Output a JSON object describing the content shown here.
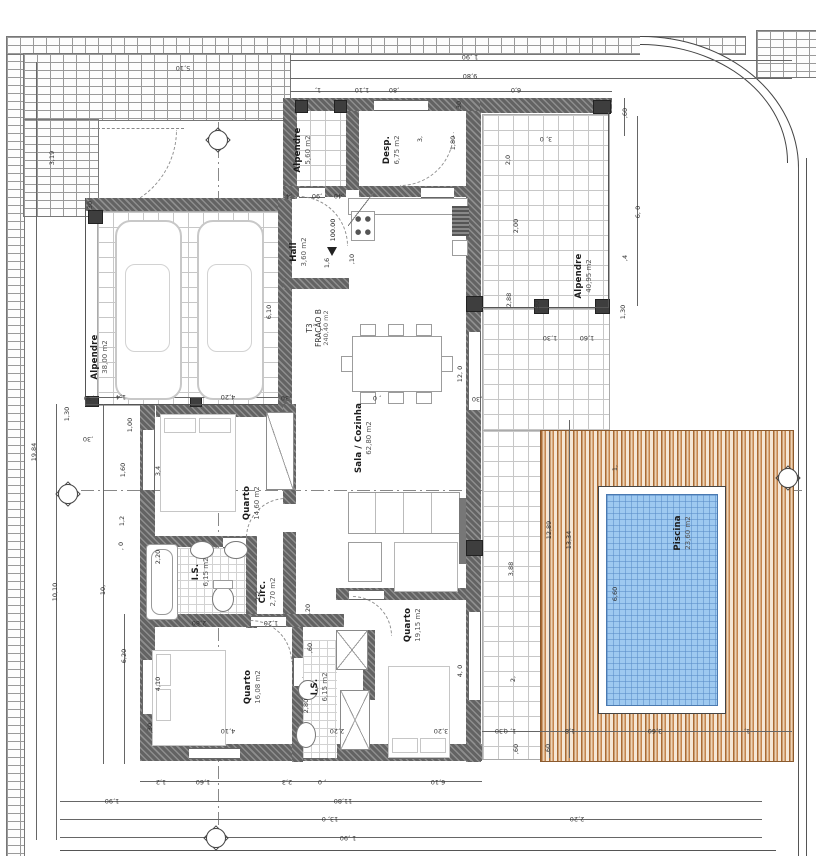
{
  "drawing": {
    "type_label": "T3",
    "fraction_label": "FRAÇÃO B",
    "fraction_area": "240,40 m2",
    "level": "100.00"
  },
  "colors": {
    "wall": "#636363",
    "pool_fill": "#9ec9f0",
    "deck_brown": "#a96a33",
    "line": "#444444"
  },
  "rooms": {
    "alpendre_garage": {
      "name": "Alpendre",
      "area": "38,00 m2"
    },
    "alpendre_small": {
      "name": "Alpendre",
      "area": "5,60 m2"
    },
    "desp": {
      "name": "Desp.",
      "area": "6,75 m2"
    },
    "hall": {
      "name": "Hall",
      "area": "3,60 m2"
    },
    "sala": {
      "name": "Sala / Cozinha",
      "area": "62,80 m2"
    },
    "alpendre_right": {
      "name": "Alpendre",
      "area": "40,95 m2"
    },
    "quarto1": {
      "name": "Quarto",
      "area": "14,60 m2"
    },
    "is1": {
      "name": "I.S.",
      "area": "6,15 m2"
    },
    "circ": {
      "name": "Circ.",
      "area": "2,70 m2"
    },
    "quarto2": {
      "name": "Quarto",
      "area": "16,08 m2"
    },
    "is2": {
      "name": "I.S.",
      "area": "6,15 m2"
    },
    "quarto3": {
      "name": "Quarto",
      "area": "19,15 m2"
    },
    "piscina": {
      "name": "Piscina",
      "area": "23,60 m2"
    }
  },
  "dim_labels": [
    {
      "t": "1 ,90",
      "x": 470,
      "y": 57,
      "r": 180
    },
    {
      "t": "9,80",
      "x": 470,
      "y": 76,
      "r": 180
    },
    {
      "t": "1,",
      "x": 318,
      "y": 90,
      "r": 180
    },
    {
      "t": "1,10",
      "x": 362,
      "y": 90,
      "r": 180
    },
    {
      "t": ",80",
      "x": 394,
      "y": 90,
      "r": 180
    },
    {
      "t": "6,0",
      "x": 516,
      "y": 90,
      "r": 180
    },
    {
      "t": "5,10",
      "x": 183,
      "y": 68,
      "r": 180
    },
    {
      "t": ",60",
      "x": 625,
      "y": 113,
      "r": -90
    },
    {
      "t": "3, 0",
      "x": 546,
      "y": 139,
      "r": 180
    },
    {
      "t": ",30",
      "x": 459,
      "y": 106,
      "r": -90
    },
    {
      "t": "2,0",
      "x": 508,
      "y": 160,
      "r": -90
    },
    {
      "t": "2,00",
      "x": 516,
      "y": 226,
      "r": -90
    },
    {
      "t": "2,88",
      "x": 509,
      "y": 300,
      "r": -90
    },
    {
      "t": "6, 0",
      "x": 638,
      "y": 212,
      "r": -90
    },
    {
      "t": ",4",
      "x": 625,
      "y": 258,
      "r": -90
    },
    {
      "t": "1,30",
      "x": 623,
      "y": 312,
      "r": -90
    },
    {
      "t": ",30",
      "x": 537,
      "y": 306,
      "r": -90
    },
    {
      "t": "1,30",
      "x": 550,
      "y": 338,
      "r": 180
    },
    {
      "t": "1,60",
      "x": 587,
      "y": 338,
      "r": 180
    },
    {
      "t": "19,84",
      "x": 34,
      "y": 452,
      "r": -90
    },
    {
      "t": "10,10",
      "x": 55,
      "y": 592,
      "r": -90
    },
    {
      "t": "10,",
      "x": 103,
      "y": 590,
      "r": -90
    },
    {
      "t": "6,20",
      "x": 124,
      "y": 656,
      "r": -90
    },
    {
      "t": "3,19",
      "x": 52,
      "y": 158,
      "r": -90
    },
    {
      "t": ",30",
      "x": 90,
      "y": 206,
      "r": -90
    },
    {
      "t": "6,10",
      "x": 269,
      "y": 312,
      "r": -90
    },
    {
      "t": "1,4",
      "x": 121,
      "y": 397,
      "r": 180
    },
    {
      "t": "4,20",
      "x": 228,
      "y": 397,
      "r": 180
    },
    {
      "t": ",30",
      "x": 89,
      "y": 398,
      "r": 180
    },
    {
      "t": ",30",
      "x": 286,
      "y": 398,
      "r": 180
    },
    {
      "t": "1,30",
      "x": 67,
      "y": 414,
      "r": -90
    },
    {
      "t": ",30",
      "x": 88,
      "y": 439,
      "r": 180
    },
    {
      "t": "1,00",
      "x": 130,
      "y": 425,
      "r": -90
    },
    {
      "t": "1,60",
      "x": 123,
      "y": 470,
      "r": -90
    },
    {
      "t": "1,2",
      "x": 122,
      "y": 521,
      "r": -90
    },
    {
      "t": ", 0",
      "x": 121,
      "y": 546,
      "r": -90
    },
    {
      "t": "3,4",
      "x": 158,
      "y": 471,
      "r": -90
    },
    {
      "t": "2,20",
      "x": 158,
      "y": 557,
      "r": -90
    },
    {
      "t": "2,2",
      "x": 258,
      "y": 596,
      "r": -90
    },
    {
      "t": ",20",
      "x": 308,
      "y": 609,
      "r": -90
    },
    {
      "t": "1,6",
      "x": 327,
      "y": 263,
      "r": -90
    },
    {
      "t": ",10",
      "x": 352,
      "y": 259,
      "r": -90
    },
    {
      "t": ",40",
      "x": 339,
      "y": 196,
      "r": 180
    },
    {
      "t": ",90",
      "x": 317,
      "y": 196,
      "r": 180
    },
    {
      "t": ",4",
      "x": 289,
      "y": 196,
      "r": 180
    },
    {
      "t": "1,80",
      "x": 453,
      "y": 143,
      "r": -90
    },
    {
      "t": "3,",
      "x": 420,
      "y": 139,
      "r": -90
    },
    {
      "t": "12, 0",
      "x": 460,
      "y": 374,
      "r": -90
    },
    {
      "t": ", 0",
      "x": 377,
      "y": 398,
      "r": 180
    },
    {
      "t": ",30",
      "x": 477,
      "y": 399,
      "r": 180
    },
    {
      "t": "2,80",
      "x": 199,
      "y": 623,
      "r": 180
    },
    {
      "t": "1,20",
      "x": 271,
      "y": 623,
      "r": 180
    },
    {
      "t": ",60",
      "x": 310,
      "y": 648,
      "r": -90
    },
    {
      "t": "4,10",
      "x": 158,
      "y": 684,
      "r": -90
    },
    {
      "t": "4,10",
      "x": 228,
      "y": 731,
      "r": 180
    },
    {
      "t": ",30",
      "x": 150,
      "y": 728,
      "r": -90
    },
    {
      "t": "2,20",
      "x": 337,
      "y": 731,
      "r": 180
    },
    {
      "t": "2,80",
      "x": 306,
      "y": 706,
      "r": -90
    },
    {
      "t": "4, 0",
      "x": 460,
      "y": 671,
      "r": -90
    },
    {
      "t": "3,20",
      "x": 441,
      "y": 731,
      "r": 180
    },
    {
      "t": ",30",
      "x": 500,
      "y": 731,
      "r": 180
    },
    {
      "t": "1,2",
      "x": 161,
      "y": 782,
      "r": 180
    },
    {
      "t": "1,60",
      "x": 203,
      "y": 782,
      "r": 180
    },
    {
      "t": "2,3",
      "x": 287,
      "y": 782,
      "r": 180
    },
    {
      "t": ", 0",
      "x": 322,
      "y": 782,
      "r": 180
    },
    {
      "t": "6,10",
      "x": 438,
      "y": 782,
      "r": 180
    },
    {
      "t": "1,90",
      "x": 112,
      "y": 801,
      "r": 180
    },
    {
      "t": "11,80",
      "x": 343,
      "y": 801,
      "r": 180
    },
    {
      "t": "13, 0",
      "x": 330,
      "y": 819,
      "r": 180
    },
    {
      "t": "1 ,90",
      "x": 348,
      "y": 838,
      "r": 180
    },
    {
      "t": "12,89",
      "x": 549,
      "y": 530,
      "r": -90
    },
    {
      "t": "13,34",
      "x": 569,
      "y": 540,
      "r": -90
    },
    {
      "t": "6,60",
      "x": 615,
      "y": 594,
      "r": -90
    },
    {
      "t": "1,",
      "x": 615,
      "y": 468,
      "r": -90
    },
    {
      "t": "3,88",
      "x": 511,
      "y": 569,
      "r": -90
    },
    {
      "t": "2,",
      "x": 513,
      "y": 679,
      "r": -90
    },
    {
      "t": "1,8",
      "x": 570,
      "y": 731,
      "r": 180
    },
    {
      "t": "3,60",
      "x": 655,
      "y": 731,
      "r": 180
    },
    {
      "t": "1,",
      "x": 747,
      "y": 731,
      "r": 180
    },
    {
      "t": "1, 0",
      "x": 510,
      "y": 731,
      "r": 180
    },
    {
      "t": ",60",
      "x": 548,
      "y": 749,
      "r": -90
    },
    {
      "t": ",60",
      "x": 516,
      "y": 749,
      "r": -90
    },
    {
      "t": "2,20",
      "x": 577,
      "y": 819,
      "r": 180
    }
  ]
}
